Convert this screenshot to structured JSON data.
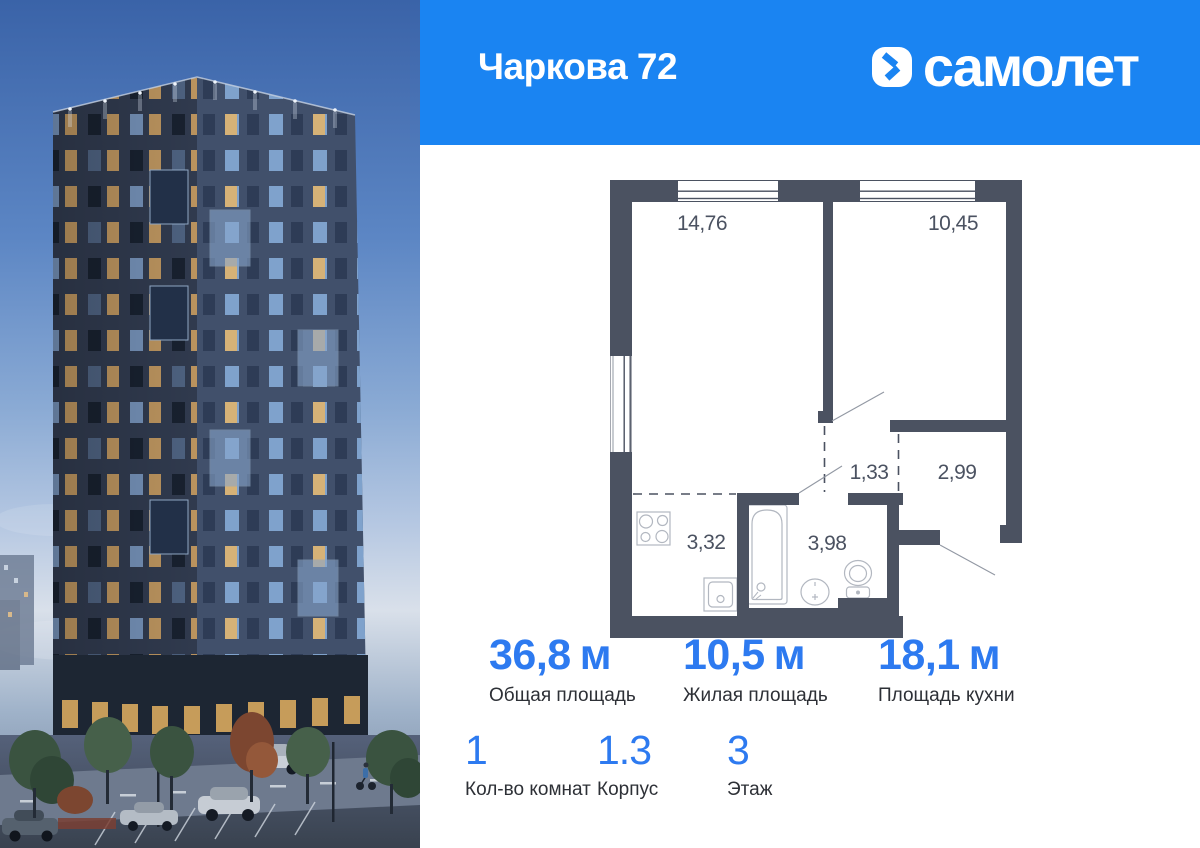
{
  "header": {
    "project_name": "Чаркова 72",
    "brand_name": "самолет"
  },
  "floor_plan": {
    "room_areas": {
      "living": "14,76",
      "bedroom": "10,45",
      "hallway": "1,33",
      "entry": "2,99",
      "kitchen": "3,32",
      "bathroom": "3,98"
    }
  },
  "stats_primary": [
    {
      "value": "36,8",
      "unit": "м",
      "label": "Общая площадь"
    },
    {
      "value": "10,5",
      "unit": "м",
      "label": "Жилая площадь"
    },
    {
      "value": "18,1",
      "unit": "м",
      "label": "Площадь кухни"
    }
  ],
  "stats_secondary": [
    {
      "value": "1",
      "label": "Кол-во комнат"
    },
    {
      "value": "1.3",
      "label": "Корпус"
    },
    {
      "value": "3",
      "label": "Этаж"
    }
  ],
  "colors": {
    "banner_blue": "#1a84f2",
    "accent_blue": "#2d7af0",
    "plan_wall_gray": "#4b5261"
  }
}
